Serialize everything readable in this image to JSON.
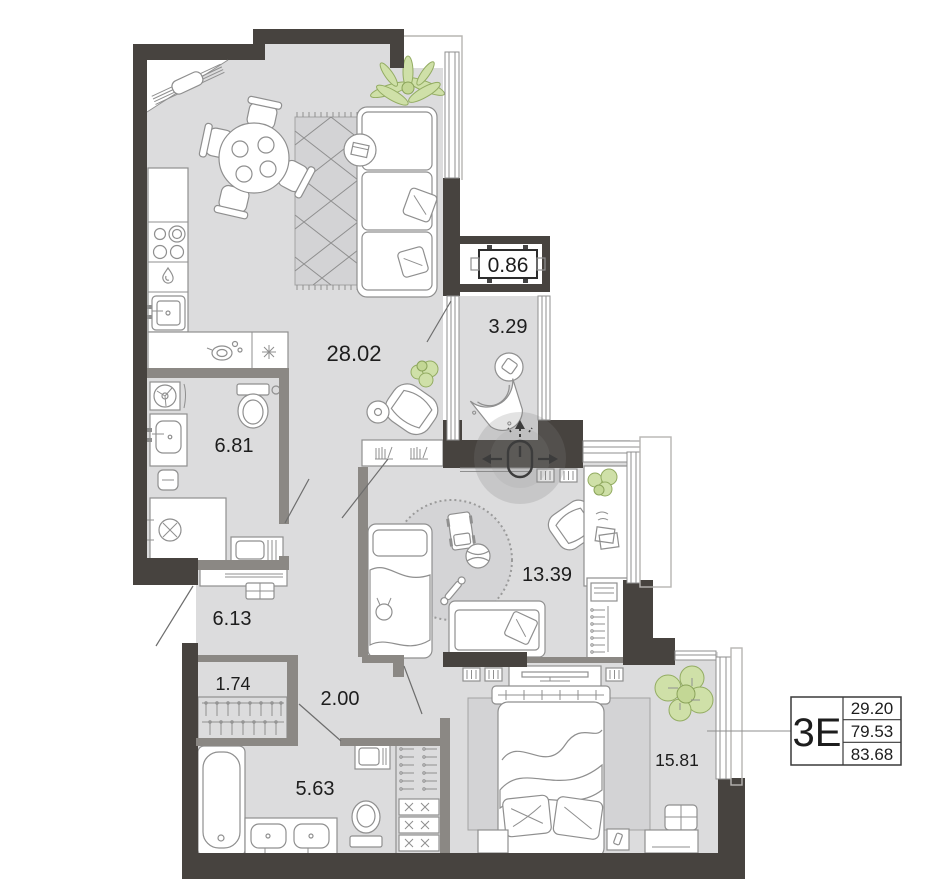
{
  "apartment": {
    "type_label": "3Е",
    "stats": [
      "29.20",
      "79.53",
      "83.68"
    ]
  },
  "rooms": [
    {
      "name": "kitchen-living-room",
      "area": "28.02"
    },
    {
      "name": "loggia",
      "area": "3.29"
    },
    {
      "name": "balcony",
      "area": "0.86"
    },
    {
      "name": "bathroom",
      "area": "6.81"
    },
    {
      "name": "hallway",
      "area": "6.13"
    },
    {
      "name": "closet",
      "area": "1.74"
    },
    {
      "name": "corridor",
      "area": "2.00"
    },
    {
      "name": "bathroom-2",
      "area": "5.63"
    },
    {
      "name": "kids-room",
      "area": "13.39"
    },
    {
      "name": "bedroom",
      "area": "15.81"
    }
  ],
  "overlay": {
    "icon": "mouse-pan-icon"
  },
  "colors": {
    "wall": "#47433f",
    "floor": "#dcdcdd",
    "plant_fill": "#cfe0a8",
    "rug": "#d3d3d5",
    "text": "#1d1d1d"
  }
}
